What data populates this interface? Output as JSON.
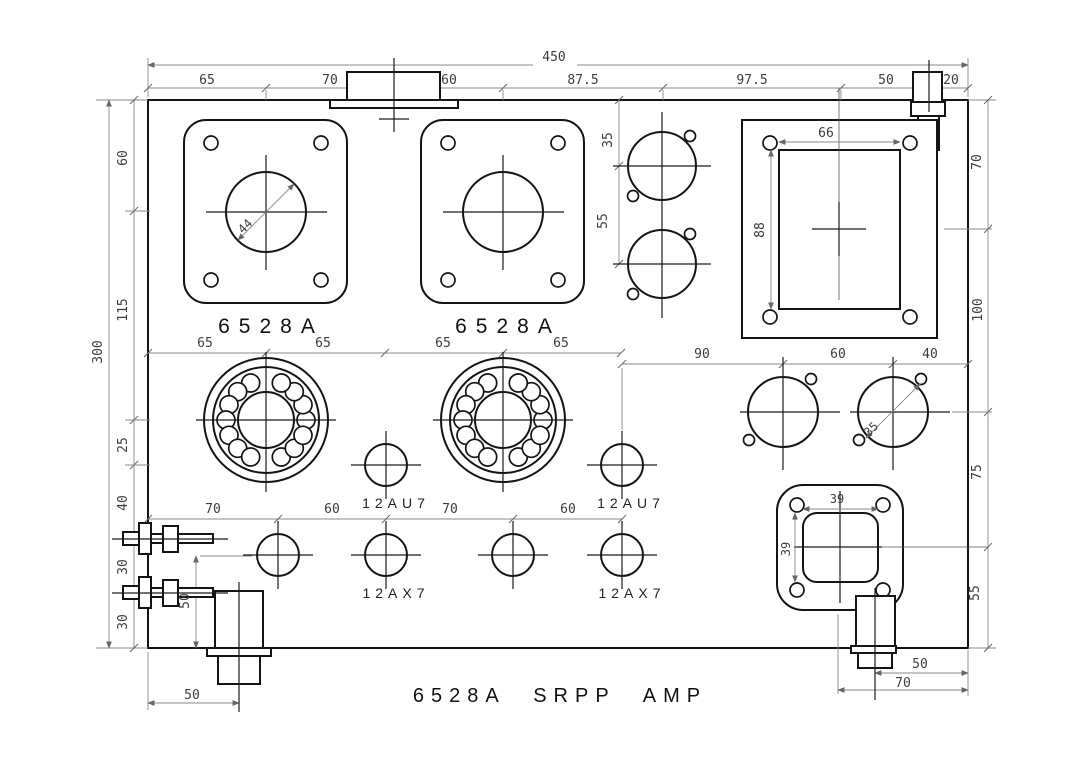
{
  "title": "6528A SRPP AMP",
  "labels": {
    "power_tube": "6528A",
    "driver_tube": "12AU7",
    "input_tube": "12AX7"
  },
  "dims": {
    "top_total": "450",
    "top": [
      "65",
      "70",
      "60",
      "87.5",
      "97.5",
      "50",
      "20"
    ],
    "left_total": "300",
    "left": [
      "60",
      "115",
      "25",
      "40",
      "30",
      "30"
    ],
    "right": [
      "70",
      "100",
      "75",
      "55"
    ],
    "socket_row": [
      "65",
      "65",
      "65",
      "65"
    ],
    "preamp_row": [
      "70",
      "60",
      "70",
      "60"
    ],
    "right_circles": [
      "90",
      "60",
      "40"
    ],
    "right_circle_dia": "35",
    "top_circles": [
      "35",
      "55"
    ],
    "cutout_w": "66",
    "cutout_h": "88",
    "iec_w": "39",
    "iec_h": "39",
    "plate_hole_dia": "44",
    "bottom_left_v": "50",
    "bottom_left_h": "50",
    "bottom_right": [
      "50",
      "70"
    ]
  }
}
